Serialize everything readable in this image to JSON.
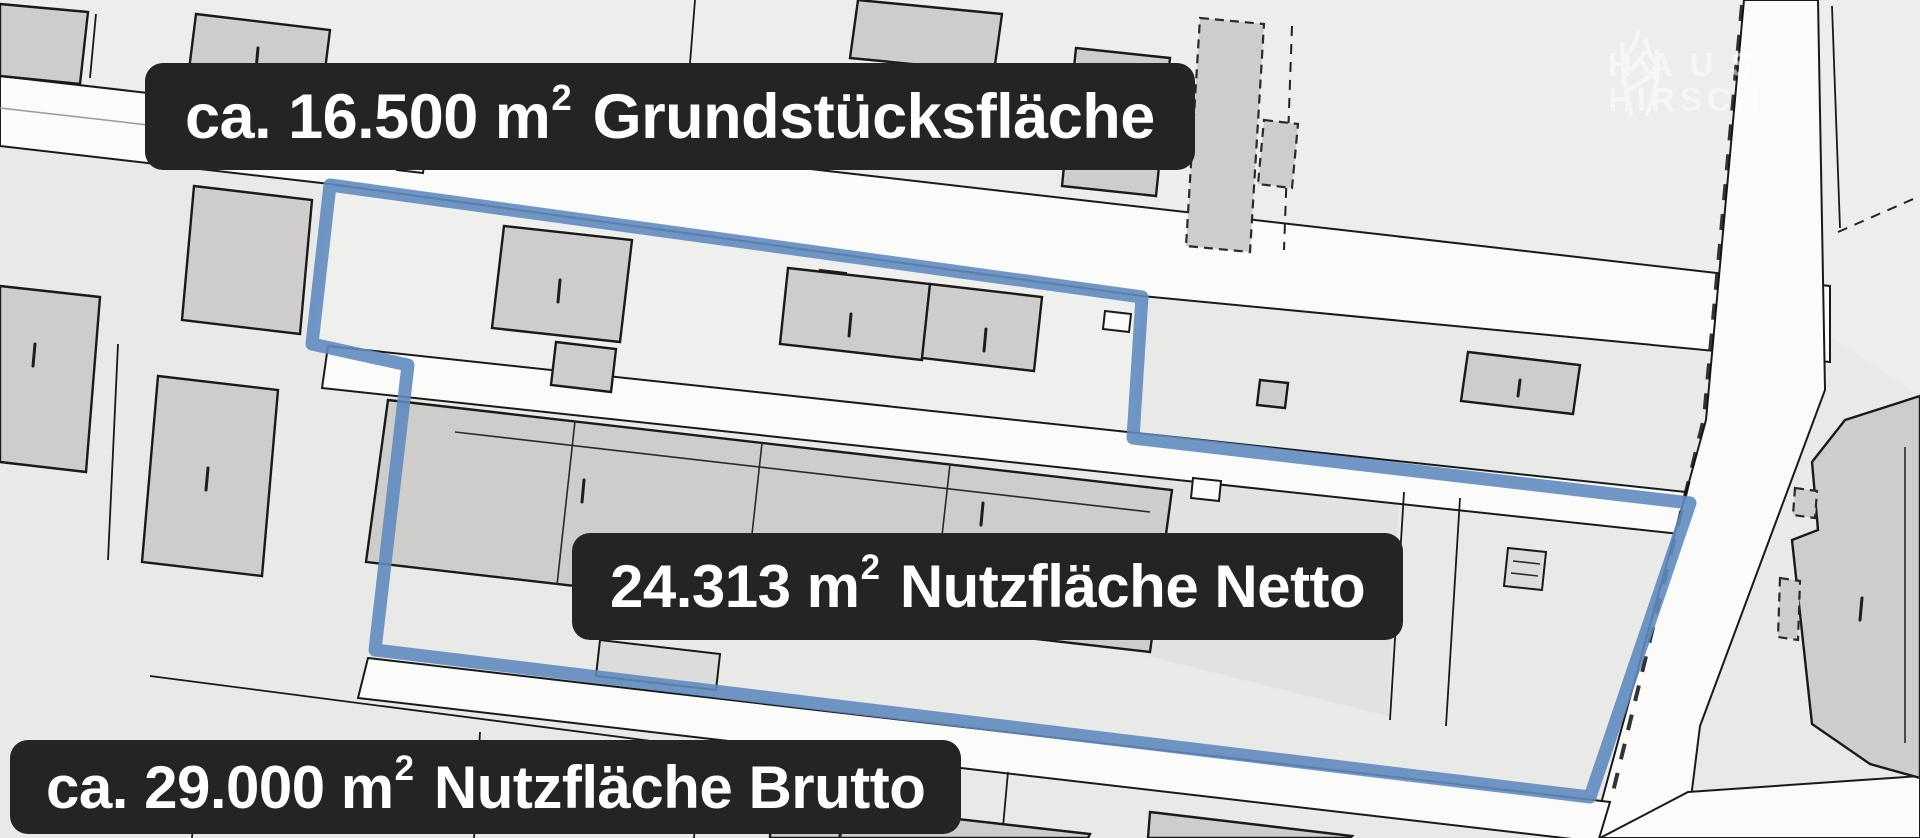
{
  "colors": {
    "boundary_blue": "#5f8bbe",
    "label_bg": "#242424",
    "label_text": "#ffffff",
    "map_bg": "#e9e9e8",
    "map_bg_north": "#ededec",
    "parcel_dark": "#e2e2e1",
    "road_fill": "#fbfbfa",
    "building_fill": "#cecdcc",
    "building_fill_light": "#dcdcdb",
    "line_color": "#1a1a1a",
    "logo_color": "#ffffff"
  },
  "annotations": {
    "plot_area": {
      "prefix": "ca. 16.500 m",
      "sup": "2",
      "name": "Grundstücksfläche"
    },
    "net_usable_area": {
      "prefix": "24.313 m",
      "sup": "2",
      "name": "Nutzfläche Netto"
    },
    "gross_usable_area": {
      "prefix": "ca. 29.000 m",
      "sup": "2",
      "name": "Nutzfläche Brutto"
    }
  },
  "logo": {
    "line1": "HAUS",
    "line2": "HIRSCH",
    "icon": "antlers-icon"
  }
}
